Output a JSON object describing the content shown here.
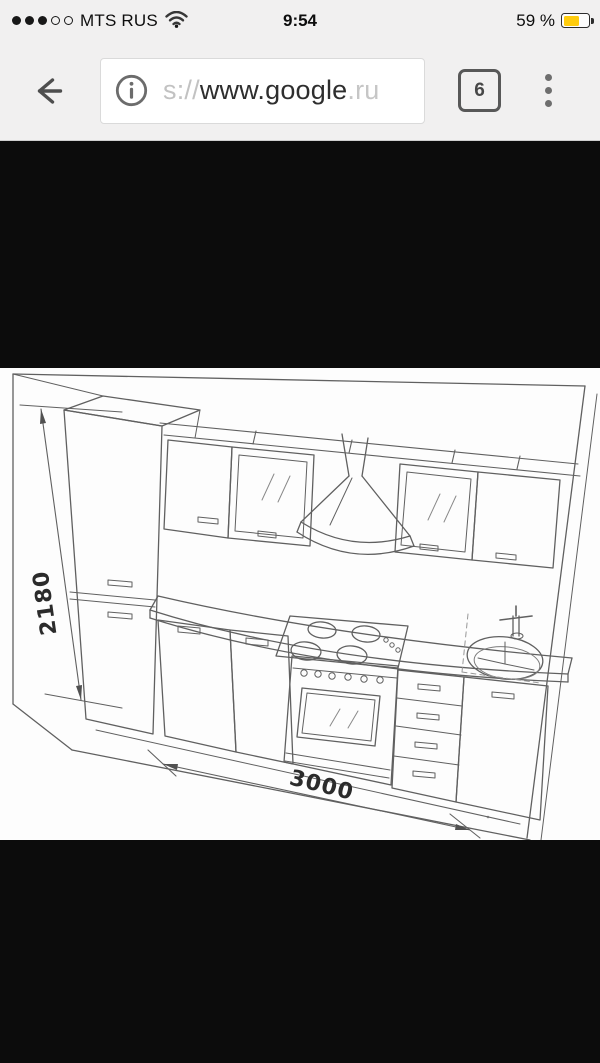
{
  "status_bar": {
    "carrier": "MTS RUS",
    "signal": {
      "filled_dots": 3,
      "total_dots": 5
    },
    "time": "9:54",
    "battery": {
      "percent_label": "59 %",
      "fill_style": "width:59%",
      "color": "#ffcc0d"
    }
  },
  "toolbar": {
    "url": {
      "scheme_prefix": "s://",
      "host": "www.google",
      "tld": ".ru"
    },
    "tab_count": "6",
    "icons": {
      "back": "left-arrow",
      "page_info": "info-circle",
      "tabs": "rounded-square-with-count",
      "menu": "vertical-kebab-dots"
    }
  },
  "content": {
    "description": "black letterboxed web image: perspective line drawing of a kitchen unit",
    "drawing": {
      "kind": "kitchen elevation sketch",
      "height_dimension_label": "2180",
      "width_dimension_label": "3000",
      "visible_elements": [
        "tall cabinet with two doors",
        "wall cabinets with glass doors",
        "range hood with duct",
        "cooktop with four burners",
        "oven with control knobs and glass door",
        "four-drawer unit",
        "sink base cabinet",
        "round sink with faucet"
      ]
    },
    "colors": {
      "letterbox": "#0c0c0c",
      "paper": "#fdfdfd",
      "line": "#4b4b4b"
    }
  }
}
